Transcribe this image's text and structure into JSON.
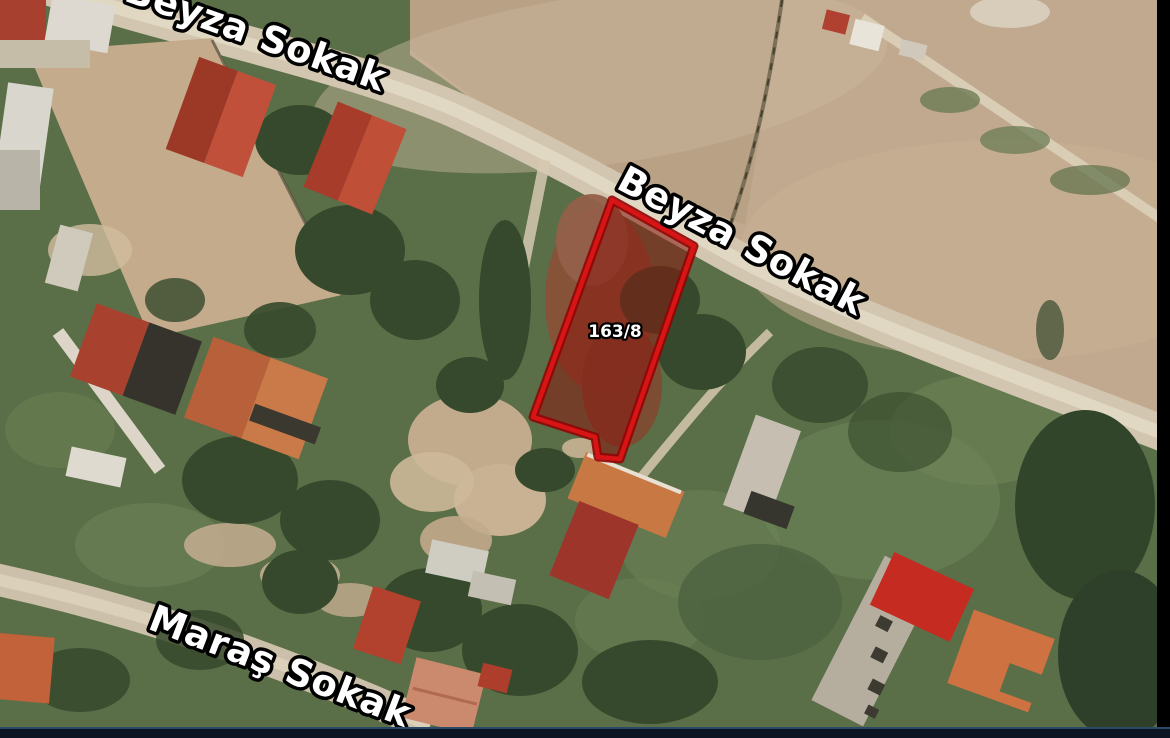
{
  "map": {
    "labels": {
      "beyza_top": "Beyza Sokak",
      "beyza_mid": "Beyza Sokak",
      "maras": "Maraş Sokak"
    },
    "parcel": {
      "number": "163/8"
    },
    "colors": {
      "parcel_outline": "#d81414",
      "parcel_outline_dark": "#8f0606",
      "parcel_fill_overlay": "rgba(136,24,14,0.55)",
      "label_fill": "#ffffff",
      "label_outline": "#000000",
      "bottom_bar": "#0a1422",
      "side_bar": "#000000"
    }
  }
}
